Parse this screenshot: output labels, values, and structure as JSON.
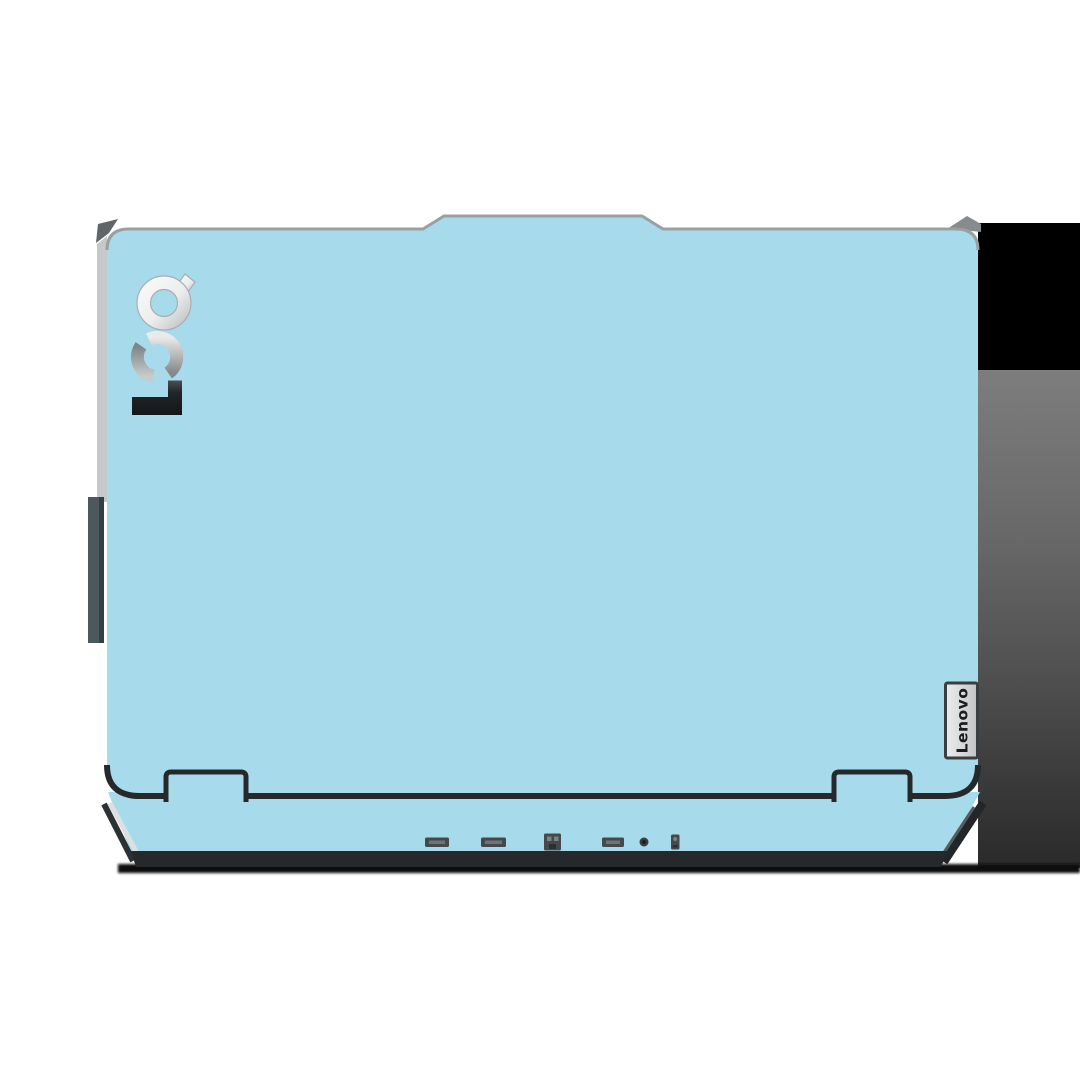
{
  "product": {
    "lid_logo": "LOQ",
    "badge_label": "Lenovo"
  },
  "colors": {
    "background": "#ffffff",
    "skin_blue": "#a7dbeb",
    "edge_dark": "#25292b",
    "silver_edge": "#c6c9ca",
    "shadow_black": "#000000",
    "shadow_gray_top": "#7d7d7d",
    "shadow_gray_bottom": "#2a2a2a",
    "logo_metal_light": "#fbfcfc",
    "logo_metal_dark": "#86898b",
    "badge_silver": "#eceded"
  },
  "ports": {
    "port1": "usb-a-port",
    "port2": "hdmi-port",
    "port3": "ethernet-port",
    "port4": "usb-a-port",
    "port5": "power-jack",
    "port6": "lock-slot"
  }
}
